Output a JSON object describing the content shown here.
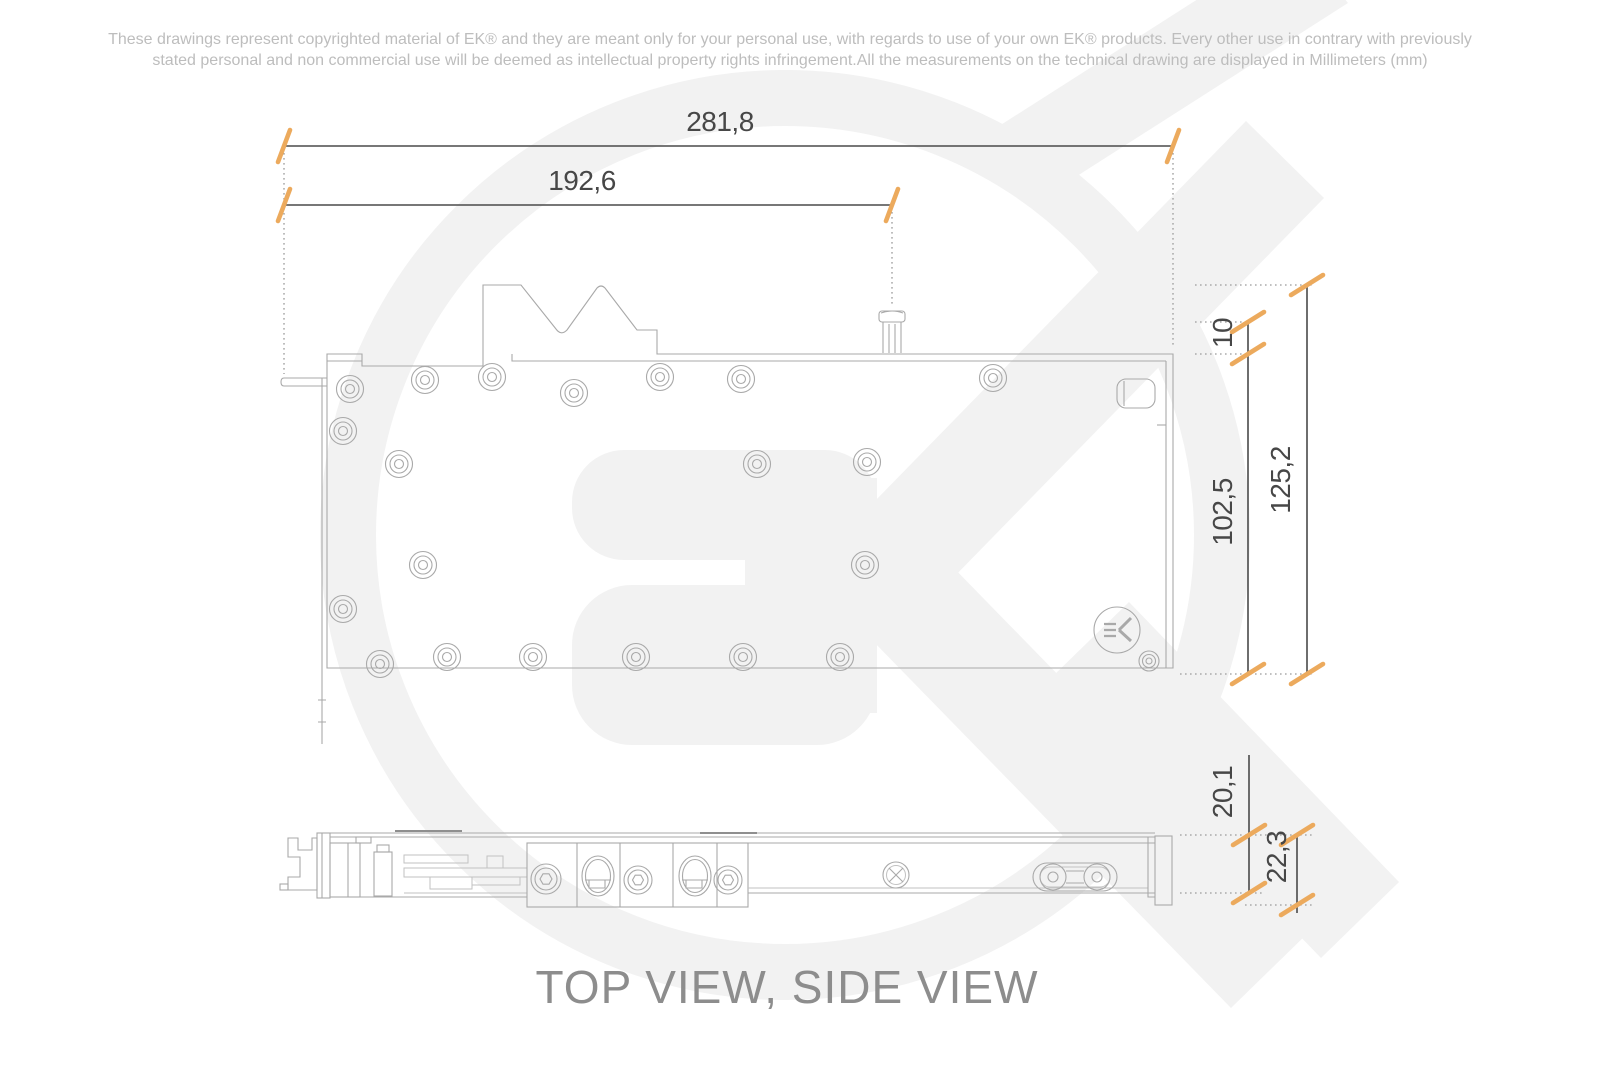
{
  "page": {
    "disclaimer_line1": "These drawings represent copyrighted material of EK® and they are meant only for your personal use, with regards to use of  your own EK® products. Every other use in contrary with previously",
    "disclaimer_line2": "stated personal and non commercial use will be deemed as intellectual property rights infringement.All the measurements on the technical drawing are displayed in Millimeters (mm)",
    "title": "TOP VIEW, SIDE VIEW"
  },
  "dimensions": {
    "overall_length": "281,8",
    "length_to_fill_port": "192,6",
    "fill_port_height": "10",
    "block_body_width": "102,5",
    "overall_width": "125,2",
    "block_thickness": "20,1",
    "overall_thickness": "22,3"
  },
  "icons": {
    "ek_plate_logo": "ek-logo-icon",
    "watermark": "ek-watermark"
  },
  "colors": {
    "accent_orange": "#ecaa5d",
    "dimension_line": "#4a4a4a",
    "dimension_text": "#474747",
    "outline_gray": "#a9a9a9",
    "watermark_gray": "#f2f2f2",
    "disclaimer_gray": "#bdbdbd",
    "title_gray": "#8d8d8d"
  }
}
